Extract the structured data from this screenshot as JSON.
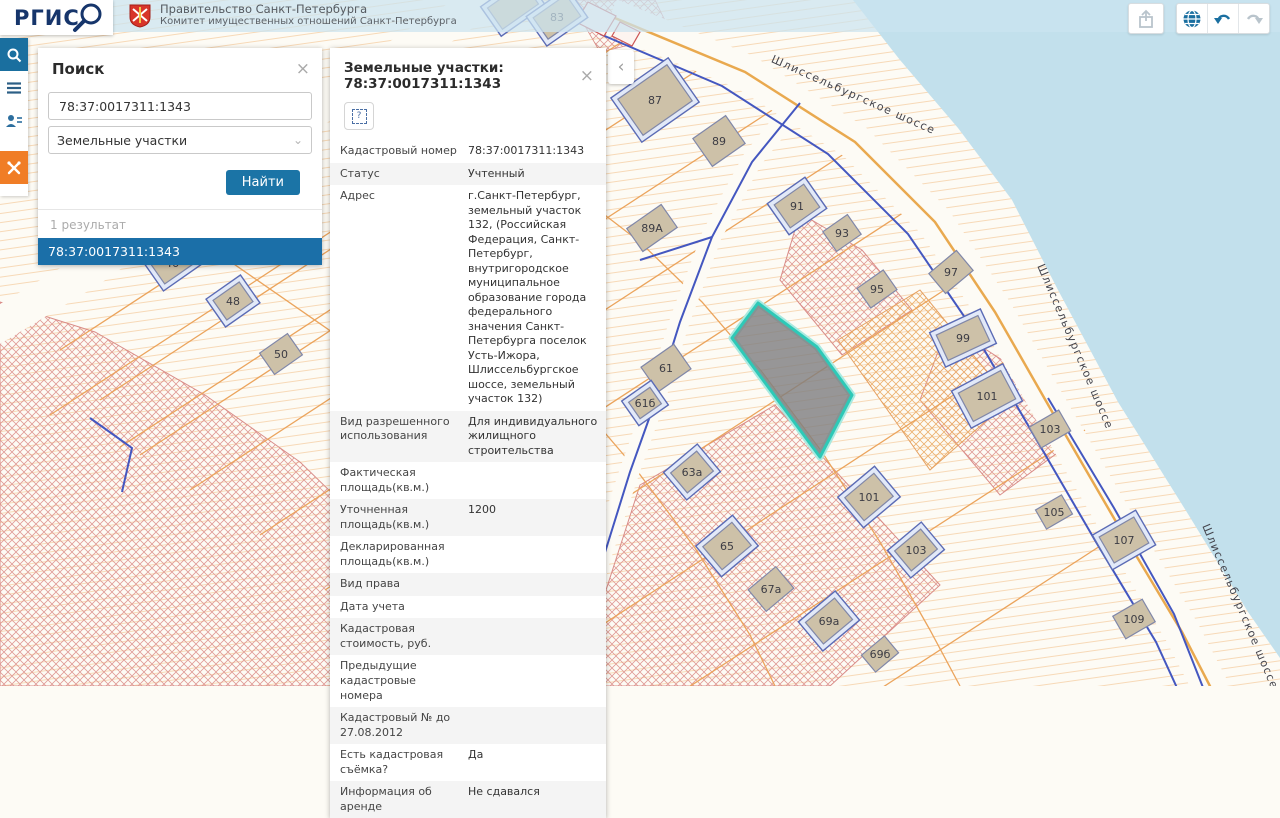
{
  "header": {
    "logo_text": "РГИС",
    "org_line1": "Правительство Санкт-Петербурга",
    "org_line2": "Комитет имущественных отношений Санкт-Петербурга"
  },
  "toolbar": {
    "icons": [
      "export",
      "globe",
      "undo",
      "redo"
    ]
  },
  "sidebar": {
    "items": [
      "search",
      "menu",
      "user-list",
      "rgis-tools"
    ]
  },
  "search_panel": {
    "title": "Поиск",
    "close_label": "×",
    "query_value": "78:37:0017311:1343",
    "category_value": "Земельные участки",
    "find_button": "Найти",
    "results_count": "1 результат",
    "result_item": "78:37:0017311:1343"
  },
  "collapse_chevron": "‹",
  "info_panel": {
    "title": "Земельные участки: 78:37:0017311:1343",
    "close_label": "×",
    "question_glyph": "?",
    "rows": [
      {
        "label": "Кадастровый номер",
        "value": "78:37:0017311:1343"
      },
      {
        "label": "Статус",
        "value": "Учтенный"
      },
      {
        "label": "Адрес",
        "value": "г.Санкт-Петербург, земельный участок 132, (Российская Федерация, Санкт-Петербург, внутригородское муниципальное образование города федерального значения Санкт-Петербурга поселок Усть-Ижора, Шлиссельбургское шоссе, земельный участок 132)"
      },
      {
        "label": "Вид разрешенного использования",
        "value": "Для индивидуального жилищного строительства"
      },
      {
        "label": "Фактическая площадь(кв.м.)",
        "value": ""
      },
      {
        "label": "Уточненная площадь(кв.м.)",
        "value": "1200"
      },
      {
        "label": "Декларированная площадь(кв.м.)",
        "value": ""
      },
      {
        "label": "Вид права",
        "value": ""
      },
      {
        "label": "Дата учета",
        "value": ""
      },
      {
        "label": "Кадастровая стоимость, руб.",
        "value": ""
      },
      {
        "label": "Предыдущие кадастровые номера",
        "value": ""
      },
      {
        "label": "Кадастровый № до 27.08.2012",
        "value": ""
      },
      {
        "label": "Есть кадастровая съёмка?",
        "value": "Да"
      },
      {
        "label": "Информация об аренде",
        "value": "Не сдавался"
      }
    ]
  },
  "map": {
    "street_name": "Шлиссельбургское шоссе",
    "selected_parcel_id": "78:37:0017311:1343",
    "selected_parcel": {
      "points": "758,303 817,347 852,395 820,457 732,338",
      "fill": "rgba(125,125,128,0.8)",
      "halo": "#a9e9e0",
      "stroke": "#2ec9b7"
    },
    "street_labels": [
      {
        "x": 852,
        "y": 98,
        "r": 24
      },
      {
        "x": 1072,
        "y": 348,
        "r": 67
      },
      {
        "x": 1237,
        "y": 608,
        "r": 67
      }
    ],
    "layers": [
      {
        "n": "land",
        "d": "M0,0H1280V686H0Z",
        "f": "#fdfbf5"
      },
      {
        "n": "land-hatch",
        "d": "M0,0H1280V686H0Z",
        "f": "url(#hatchOrange)",
        "o": 0.55
      },
      {
        "n": "crosshatch-zone-sw",
        "d": "M0,302 L95,332 205,395 300,462 370,530 420,600 438,686 L0,686 Z",
        "f": "url(#hatchRed)",
        "s": "#d98c88",
        "w": 1
      },
      {
        "n": "crosshatch-zone-south",
        "d": "M640,485 L775,405 940,585 830,686 575,686 Z",
        "f": "url(#hatchRed)",
        "s": "#d98c88",
        "w": 1
      },
      {
        "n": "crosshatch-zone-east",
        "d": "M948,325 L1030,378 1075,440 1000,495 920,400 Z",
        "f": "url(#hatchRed)",
        "s": "#d98c88",
        "w": 1
      },
      {
        "n": "crosshatch-zone-mid",
        "d": "M800,213 L862,250 912,310 842,355 780,280 Z",
        "f": "url(#hatchRed)",
        "s": "#d98c88",
        "w": 1
      },
      {
        "n": "crosshatch-zone-center",
        "d": "M838,340 L920,290 1010,400 930,470 Z",
        "f": "url(#hatchOrangeX)",
        "s": "#e5a060",
        "w": 1
      },
      {
        "n": "crosshatch-zone-top",
        "d": "M570,0 L655,0 672,35 600,52 Z",
        "f": "url(#hatchRed)",
        "s": "#d98c88",
        "w": 0.8
      },
      {
        "n": "parcel-line",
        "d": "M640,30 L50,415",
        "s": "#eba45c",
        "w": 1.3
      },
      {
        "n": "parcel-line",
        "d": "M710,62 L120,447",
        "s": "#eba45c",
        "w": 1.3
      },
      {
        "n": "parcel-line",
        "d": "M780,105 L190,490",
        "s": "#eba45c",
        "w": 1.3
      },
      {
        "n": "parcel-line",
        "d": "M850,150 L260,535",
        "s": "#eba45c",
        "w": 1.3
      },
      {
        "n": "parcel-line",
        "d": "M915,205 L325,590",
        "s": "#eba45c",
        "w": 1.3
      },
      {
        "n": "parcel-line",
        "d": "M975,270 L385,655",
        "s": "#eba45c",
        "w": 1.3
      },
      {
        "n": "parcel-line",
        "d": "M1030,345 L460,718",
        "s": "#eba45c",
        "w": 1.3
      },
      {
        "n": "parcel-line",
        "d": "M1085,430 L530,790",
        "s": "#eba45c",
        "w": 1.3
      },
      {
        "n": "parcel-line",
        "d": "M1140,520 L640,845",
        "s": "#eba45c",
        "w": 1.3
      },
      {
        "n": "parcel-boundary",
        "d": "M505,148 L575,192 640,242 702,302 762,372 822,452 880,542 930,630 960,686",
        "s": "#eba45c",
        "w": 1.3
      },
      {
        "n": "parcel-boundary",
        "d": "M380,240 L450,285 515,338 575,398 635,468 695,548 750,635 775,686",
        "s": "#eba45c",
        "w": 1.3
      },
      {
        "n": "parcel-line",
        "d": "M320,180 L60,350",
        "s": "#eba45c",
        "w": 1.3
      },
      {
        "n": "parcel-line",
        "d": "M360,230 L100,400",
        "s": "#eba45c",
        "w": 1.3
      },
      {
        "n": "parcel-line",
        "d": "M400,285 L140,455",
        "s": "#eba45c",
        "w": 1.3
      },
      {
        "n": "parcel-line",
        "d": "M55,140 L430,400",
        "s": "#eba45c",
        "w": 1.3
      },
      {
        "n": "road-corridor",
        "d": "M500,-10 L300,120 90,270 -10,330",
        "s": "#fdfbf5",
        "w": 34
      },
      {
        "n": "road-corridor",
        "d": "M463,60 L432,220 436,400 452,560 443,690",
        "s": "#fdfbf5",
        "w": 30
      },
      {
        "n": "road-corridor-shore",
        "d": "M610,16 L745,72 855,142 935,222 995,312 1058,422 1122,532 1182,632 1212,690",
        "s": "#fdfbf5",
        "w": 36
      },
      {
        "n": "road-corridor-branch",
        "d": "M800,100 L752,160 712,235 680,320 655,400 630,470 600,560 578,650 572,690",
        "s": "#fdfbf5",
        "w": 20
      },
      {
        "n": "water",
        "d": "M853,0 L900,60 958,128 1012,200 1058,290 1118,402 1188,514 1248,612 1280,658 L1280,0 Z",
        "f": "#c2e0ec"
      },
      {
        "n": "road-centerline",
        "d": "M610,16 L745,72 855,142 935,222 995,312 1058,422 1122,532 1182,632 1212,690",
        "s": "#e9a94f",
        "w": 2.5
      },
      {
        "n": "road-edge",
        "d": "M600,34 L722,86 828,154 908,234 968,322 1032,432 1096,542 1156,642 1178,690",
        "s": "#4457c0",
        "w": 2
      },
      {
        "n": "road-edge",
        "d": "M1048,398 L1114,508 1174,614 1204,690",
        "s": "#4457c0",
        "w": 2
      },
      {
        "n": "road-edge-branch",
        "d": "M800,103 L752,162 712,237 680,322 655,402 630,472 602,562 580,652 574,690",
        "s": "#4457c0",
        "w": 2
      },
      {
        "n": "road-edge-spur",
        "d": "M712,237 L640,260",
        "s": "#4457c0",
        "w": 2
      },
      {
        "n": "ditch-line",
        "d": "M90,418 L132,448 122,492",
        "s": "#4457c0",
        "w": 2
      },
      {
        "n": "ditch-line",
        "d": "M448,538 L478,572 460,612 432,645",
        "s": "#4457c0",
        "w": 2
      },
      {
        "n": "structure-outline",
        "d": "M588,2 L616,16 604,36 576,22 Z",
        "s": "#cc5555",
        "w": 1.2,
        "f": "#fdf4f0"
      },
      {
        "n": "structure-outline",
        "d": "M620,22 L640,32 632,46 612,36 Z",
        "s": "#cc5555",
        "w": 1.2,
        "f": "#fdf4f0"
      }
    ],
    "buildings": [
      {
        "label": "",
        "x": 513,
        "y": 6,
        "w": 44,
        "h": 26,
        "r": -35,
        "halo": true
      },
      {
        "label": "83",
        "x": 557,
        "y": 17,
        "w": 40,
        "h": 26,
        "r": -35,
        "halo": true
      },
      {
        "label": "87",
        "x": 655,
        "y": 100,
        "w": 60,
        "h": 44,
        "r": -35,
        "halo": true
      },
      {
        "label": "89",
        "x": 719,
        "y": 141,
        "w": 40,
        "h": 34,
        "r": -35
      },
      {
        "label": "89А",
        "x": 652,
        "y": 228,
        "w": 42,
        "h": 28,
        "r": -35
      },
      {
        "label": "91",
        "x": 797,
        "y": 206,
        "w": 36,
        "h": 28,
        "r": -35,
        "halo": true
      },
      {
        "label": "93",
        "x": 842,
        "y": 233,
        "w": 30,
        "h": 24,
        "r": -35
      },
      {
        "label": "95",
        "x": 877,
        "y": 289,
        "w": 32,
        "h": 24,
        "r": -35
      },
      {
        "label": "97",
        "x": 951,
        "y": 272,
        "w": 36,
        "h": 26,
        "r": -40
      },
      {
        "label": "99",
        "x": 963,
        "y": 338,
        "w": 46,
        "h": 28,
        "r": -25,
        "halo": true
      },
      {
        "label": "101",
        "x": 987,
        "y": 396,
        "w": 48,
        "h": 32,
        "r": -28,
        "halo": true
      },
      {
        "label": "103",
        "x": 1050,
        "y": 429,
        "w": 34,
        "h": 24,
        "r": -30
      },
      {
        "label": "105",
        "x": 1054,
        "y": 512,
        "w": 30,
        "h": 22,
        "r": -30
      },
      {
        "label": "107",
        "x": 1124,
        "y": 540,
        "w": 40,
        "h": 30,
        "r": -30,
        "halo": true
      },
      {
        "label": "109",
        "x": 1134,
        "y": 619,
        "w": 34,
        "h": 26,
        "r": -30
      },
      {
        "label": "101",
        "x": 869,
        "y": 497,
        "w": 38,
        "h": 30,
        "r": -40,
        "halo": true
      },
      {
        "label": "103",
        "x": 916,
        "y": 550,
        "w": 34,
        "h": 26,
        "r": -40,
        "halo": true
      },
      {
        "label": "61",
        "x": 666,
        "y": 368,
        "w": 40,
        "h": 30,
        "r": -35
      },
      {
        "label": "61б",
        "x": 645,
        "y": 403,
        "w": 26,
        "h": 20,
        "r": -35,
        "halo": true
      },
      {
        "label": "63а",
        "x": 692,
        "y": 472,
        "w": 34,
        "h": 26,
        "r": -40,
        "halo": true
      },
      {
        "label": "65",
        "x": 727,
        "y": 546,
        "w": 38,
        "h": 30,
        "r": -40,
        "halo": true
      },
      {
        "label": "67а",
        "x": 771,
        "y": 589,
        "w": 36,
        "h": 28,
        "r": -40
      },
      {
        "label": "69а",
        "x": 829,
        "y": 621,
        "w": 38,
        "h": 28,
        "r": -40,
        "halo": true
      },
      {
        "label": "69б",
        "x": 880,
        "y": 654,
        "w": 30,
        "h": 22,
        "r": -40
      },
      {
        "label": "61",
        "x": 510,
        "y": 595,
        "w": 54,
        "h": 42,
        "r": -35
      },
      {
        "label": "63",
        "x": 553,
        "y": 641,
        "w": 38,
        "h": 26,
        "r": -35,
        "halo": true
      },
      {
        "label": "58",
        "x": 437,
        "y": 662,
        "w": 40,
        "h": 30,
        "r": -35,
        "halo": true
      },
      {
        "label": "46",
        "x": 172,
        "y": 263,
        "w": 36,
        "h": 26,
        "r": -35,
        "halo": true
      },
      {
        "label": "48",
        "x": 233,
        "y": 301,
        "w": 32,
        "h": 24,
        "r": -35,
        "halo": true
      },
      {
        "label": "50",
        "x": 281,
        "y": 354,
        "w": 34,
        "h": 26,
        "r": -35
      },
      {
        "label": "",
        "x": 560,
        "y": 678,
        "w": 26,
        "h": 18,
        "r": -35
      }
    ]
  }
}
